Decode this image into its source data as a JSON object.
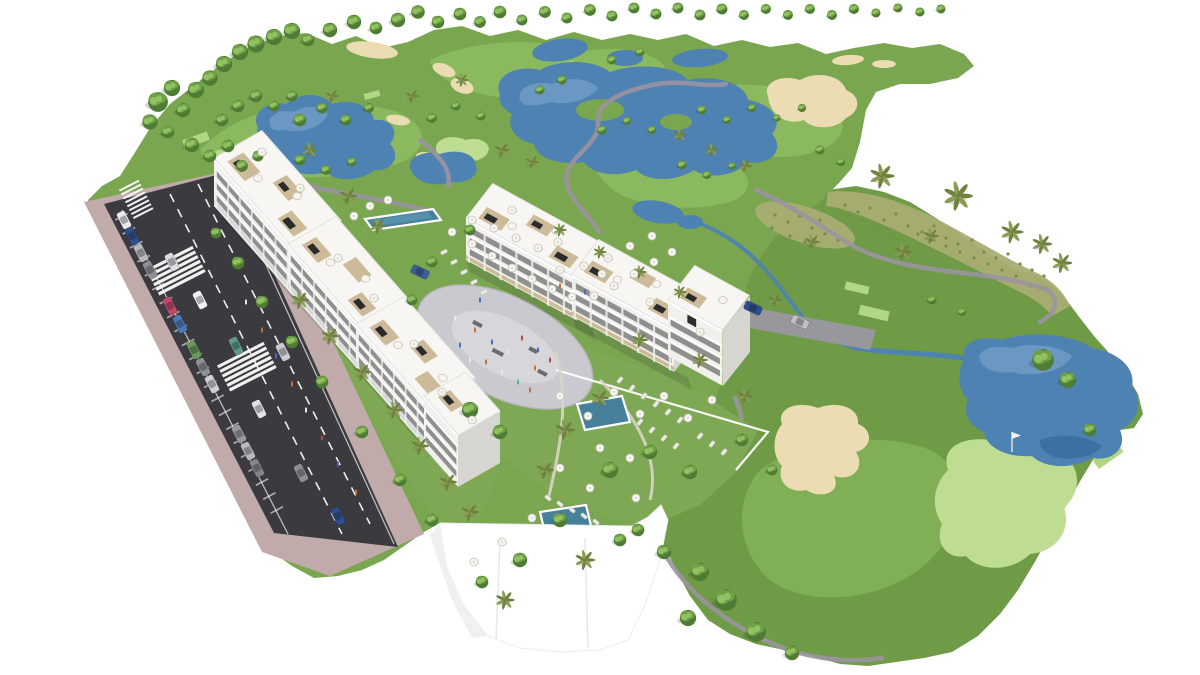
{
  "scene_label": "aerial-render-golf-resort-apartments",
  "colors": {
    "bg": "#ffffff",
    "grass": "#7aa650",
    "rough": "#6f9b47",
    "fairwayLight": "#8ebd60",
    "green": "#bedd92",
    "tee": "#b2d784",
    "sand": "#ecdcb3",
    "sandEdge": "#d5c293",
    "water": "#4d82b3",
    "waterLight": "#8db4d6",
    "waterDeep": "#2c5c94",
    "path": "#9b93a0",
    "dry": "#a9ad72",
    "drySpeck": "#7d8a4d",
    "road": "#3a3a3f",
    "sidewalk": "#c0abaa",
    "plaza": "#c9c9cf",
    "plazaInner": "#d7d7db",
    "plazaEdge": "#b7b7bd",
    "garden": "#7fa854",
    "bldg": "#f1f0ec",
    "bldgRoof": "#f7f6f3",
    "bldgShade": "#e3e2de",
    "bldgDark": "#d6d5d0",
    "win": "#3f4046",
    "wood": "#c9b692",
    "pergola": "#2b2b2d",
    "wall": "#ffffff",
    "pool": "#47809b",
    "poolLight": "#63a0b8",
    "treeDark": "#4f7c34",
    "treeMid": "#6fa046",
    "treeLight": "#92c162",
    "palm": "#6e813f",
    "palmLight": "#8a9c51",
    "trunk": "#8a7356",
    "umbTop": "#f6f5f0",
    "umbEdge": "#c9c4b8",
    "lounger": "#eceae4"
  },
  "scene": {
    "trees": [
      [
        158,
        102,
        1.1,
        "r"
      ],
      [
        172,
        88,
        0.9,
        "r"
      ],
      [
        150,
        122,
        0.85,
        "r"
      ],
      [
        183,
        110,
        0.8,
        "r"
      ],
      [
        168,
        132,
        0.7,
        "r"
      ],
      [
        196,
        90,
        0.9,
        "r"
      ],
      [
        210,
        78,
        0.85,
        "r"
      ],
      [
        224,
        64,
        0.9,
        "r"
      ],
      [
        240,
        52,
        0.9,
        "r"
      ],
      [
        256,
        44,
        0.95,
        "r"
      ],
      [
        274,
        37,
        0.9,
        "r"
      ],
      [
        292,
        31,
        0.9,
        "r"
      ],
      [
        308,
        40,
        0.7,
        "r"
      ],
      [
        222,
        120,
        0.7,
        "r"
      ],
      [
        238,
        106,
        0.7,
        "r"
      ],
      [
        256,
        96,
        0.7,
        "r"
      ],
      [
        274,
        106,
        0.6,
        "r"
      ],
      [
        292,
        96,
        0.6,
        "r"
      ],
      [
        192,
        145,
        0.8,
        "r"
      ],
      [
        210,
        156,
        0.7,
        "r"
      ],
      [
        228,
        146,
        0.7,
        "r"
      ],
      [
        242,
        166,
        0.65,
        "r"
      ],
      [
        258,
        156,
        0.6,
        "r"
      ],
      [
        330,
        30,
        0.8,
        "r"
      ],
      [
        354,
        22,
        0.8,
        "r"
      ],
      [
        376,
        28,
        0.7,
        "r"
      ],
      [
        398,
        20,
        0.8,
        "r"
      ],
      [
        418,
        12,
        0.75,
        "r"
      ],
      [
        438,
        22,
        0.7,
        "r"
      ],
      [
        460,
        14,
        0.7,
        "r"
      ],
      [
        480,
        22,
        0.65,
        "r"
      ],
      [
        500,
        12,
        0.7,
        "r"
      ],
      [
        522,
        20,
        0.6,
        "r"
      ],
      [
        545,
        12,
        0.65,
        "r"
      ],
      [
        567,
        18,
        0.6,
        "r"
      ],
      [
        590,
        10,
        0.65,
        "r"
      ],
      [
        612,
        16,
        0.6,
        "r"
      ],
      [
        634,
        8,
        0.6,
        "r"
      ],
      [
        656,
        14,
        0.6,
        "r"
      ],
      [
        678,
        8,
        0.6,
        "r"
      ],
      [
        700,
        15,
        0.6,
        "r"
      ],
      [
        722,
        9,
        0.6,
        "r"
      ],
      [
        744,
        15,
        0.55,
        "r"
      ],
      [
        766,
        9,
        0.55,
        "r"
      ],
      [
        788,
        15,
        0.55,
        "r"
      ],
      [
        810,
        9,
        0.55,
        "r"
      ],
      [
        832,
        15,
        0.55,
        "r"
      ],
      [
        854,
        9,
        0.55,
        "r"
      ],
      [
        876,
        13,
        0.5,
        "r"
      ],
      [
        898,
        8,
        0.5,
        "r"
      ],
      [
        920,
        12,
        0.5,
        "r"
      ],
      [
        941,
        9,
        0.5,
        "r"
      ],
      [
        300,
        120,
        0.7,
        "r"
      ],
      [
        322,
        108,
        0.6,
        "r"
      ],
      [
        346,
        120,
        0.6,
        "r"
      ],
      [
        369,
        108,
        0.55,
        "r"
      ],
      [
        300,
        160,
        0.6,
        "r"
      ],
      [
        326,
        170,
        0.55,
        "r"
      ],
      [
        352,
        162,
        0.5,
        "r"
      ],
      [
        432,
        118,
        0.55,
        "r"
      ],
      [
        456,
        106,
        0.5,
        "r"
      ],
      [
        481,
        116,
        0.5,
        "r"
      ],
      [
        540,
        90,
        0.5,
        "r"
      ],
      [
        562,
        80,
        0.5,
        "r"
      ],
      [
        612,
        60,
        0.5,
        "r"
      ],
      [
        640,
        52,
        0.5,
        "r"
      ],
      [
        602,
        130,
        0.5,
        "r"
      ],
      [
        627,
        121,
        0.45,
        "r"
      ],
      [
        652,
        130,
        0.45,
        "r"
      ],
      [
        702,
        110,
        0.5,
        "r"
      ],
      [
        727,
        120,
        0.45,
        "r"
      ],
      [
        752,
        108,
        0.45,
        "r"
      ],
      [
        777,
        118,
        0.4,
        "r"
      ],
      [
        802,
        108,
        0.45,
        "r"
      ],
      [
        682,
        165,
        0.5,
        "r"
      ],
      [
        707,
        175,
        0.45,
        "r"
      ],
      [
        732,
        166,
        0.4,
        "r"
      ],
      [
        820,
        150,
        0.5,
        "r"
      ],
      [
        841,
        162,
        0.45,
        "r"
      ],
      [
        1043,
        360,
        1.2,
        "r"
      ],
      [
        1068,
        380,
        0.9,
        "r"
      ],
      [
        1090,
        430,
        0.7,
        "r"
      ],
      [
        932,
        300,
        0.5,
        "r"
      ],
      [
        962,
        312,
        0.45,
        "r"
      ],
      [
        700,
        572,
        1.0,
        "r"
      ],
      [
        726,
        600,
        1.2,
        "r"
      ],
      [
        756,
        632,
        1.1,
        "r"
      ],
      [
        688,
        618,
        0.9,
        "r"
      ],
      [
        664,
        552,
        0.8,
        "r"
      ],
      [
        638,
        530,
        0.7,
        "r"
      ],
      [
        792,
        653,
        0.8,
        "r"
      ],
      [
        470,
        410,
        0.9,
        "r"
      ],
      [
        500,
        432,
        0.8,
        "r"
      ],
      [
        610,
        470,
        0.9,
        "r"
      ],
      [
        650,
        452,
        0.8,
        "r"
      ],
      [
        690,
        472,
        0.8,
        "r"
      ],
      [
        560,
        520,
        0.8,
        "r"
      ],
      [
        620,
        540,
        0.7,
        "r"
      ],
      [
        520,
        560,
        0.8,
        "r"
      ],
      [
        482,
        582,
        0.7,
        "r"
      ],
      [
        432,
        520,
        0.7,
        "r"
      ],
      [
        400,
        480,
        0.7,
        "r"
      ],
      [
        362,
        432,
        0.7,
        "r"
      ],
      [
        322,
        382,
        0.7,
        "r"
      ],
      [
        292,
        342,
        0.7,
        "r"
      ],
      [
        262,
        302,
        0.7,
        "r"
      ],
      [
        238,
        263,
        0.7,
        "r"
      ],
      [
        216,
        233,
        0.6,
        "r"
      ],
      [
        742,
        440,
        0.7,
        "r"
      ],
      [
        772,
        470,
        0.6,
        "r"
      ],
      [
        470,
        230,
        0.6,
        "r"
      ],
      [
        432,
        262,
        0.6,
        "r"
      ],
      [
        412,
        300,
        0.6,
        "r"
      ],
      [
        882,
        176,
        1.1,
        "p"
      ],
      [
        958,
        196,
        1.3,
        "p"
      ],
      [
        1012,
        232,
        1.0,
        "p"
      ],
      [
        1042,
        244,
        0.9,
        "p"
      ],
      [
        1062,
        263,
        0.9,
        "p"
      ],
      [
        903,
        252,
        0.8,
        "p"
      ],
      [
        931,
        236,
        0.7,
        "p"
      ],
      [
        348,
        196,
        0.8,
        "p"
      ],
      [
        378,
        226,
        0.75,
        "p"
      ],
      [
        300,
        300,
        0.8,
        "p"
      ],
      [
        330,
        336,
        0.8,
        "p"
      ],
      [
        362,
        372,
        0.8,
        "p"
      ],
      [
        394,
        410,
        0.8,
        "p"
      ],
      [
        420,
        446,
        0.8,
        "p"
      ],
      [
        448,
        482,
        0.8,
        "p"
      ],
      [
        470,
        512,
        0.8,
        "p"
      ],
      [
        565,
        430,
        0.9,
        "p"
      ],
      [
        600,
        398,
        0.8,
        "p"
      ],
      [
        545,
        470,
        0.8,
        "p"
      ],
      [
        585,
        560,
        0.9,
        "p"
      ],
      [
        505,
        600,
        0.85,
        "p"
      ],
      [
        640,
        340,
        0.7,
        "p"
      ],
      [
        700,
        360,
        0.7,
        "p"
      ],
      [
        745,
        396,
        0.7,
        "p"
      ],
      [
        775,
        300,
        0.6,
        "p"
      ],
      [
        812,
        242,
        0.7,
        "p"
      ],
      [
        680,
        135,
        0.6,
        "p"
      ],
      [
        712,
        150,
        0.6,
        "p"
      ],
      [
        745,
        166,
        0.6,
        "p"
      ],
      [
        310,
        150,
        0.7,
        "p"
      ],
      [
        332,
        96,
        0.6,
        "p"
      ],
      [
        502,
        150,
        0.7,
        "p"
      ],
      [
        532,
        162,
        0.6,
        "p"
      ],
      [
        412,
        96,
        0.6,
        "p"
      ],
      [
        462,
        80,
        0.6,
        "p"
      ],
      [
        560,
        230,
        0.6,
        "p"
      ],
      [
        600,
        252,
        0.6,
        "p"
      ],
      [
        640,
        272,
        0.6,
        "p"
      ],
      [
        680,
        292,
        0.6,
        "p"
      ]
    ],
    "umbrellas": [
      [
        452,
        232
      ],
      [
        472,
        244
      ],
      [
        492,
        256
      ],
      [
        512,
        268
      ],
      [
        532,
        279
      ],
      [
        552,
        289
      ],
      [
        572,
        297
      ],
      [
        594,
        296
      ],
      [
        614,
        286
      ],
      [
        634,
        274
      ],
      [
        654,
        262
      ],
      [
        672,
        252
      ],
      [
        584,
        266
      ],
      [
        560,
        270
      ],
      [
        538,
        248
      ],
      [
        516,
        238
      ],
      [
        494,
        228
      ],
      [
        472,
        220
      ],
      [
        608,
        258
      ],
      [
        630,
        246
      ],
      [
        652,
        236
      ],
      [
        370,
        206
      ],
      [
        354,
        216
      ],
      [
        388,
        200
      ],
      [
        560,
        396
      ],
      [
        588,
        416
      ],
      [
        614,
        392
      ],
      [
        640,
        414
      ],
      [
        664,
        396
      ],
      [
        688,
        418
      ],
      [
        712,
        400
      ],
      [
        600,
        448
      ],
      [
        630,
        458
      ],
      [
        560,
        468
      ],
      [
        590,
        488
      ],
      [
        636,
        498
      ],
      [
        532,
        518
      ],
      [
        502,
        542
      ],
      [
        474,
        562
      ],
      [
        262,
        152
      ],
      [
        300,
        188
      ],
      [
        338,
        258
      ],
      [
        374,
        298
      ],
      [
        414,
        344
      ],
      [
        442,
        392
      ],
      [
        472,
        420
      ],
      [
        512,
        210
      ],
      [
        558,
        242
      ],
      [
        602,
        274
      ],
      [
        650,
        302
      ],
      [
        700,
        332
      ]
    ],
    "loungers": [
      [
        620,
        380,
        40
      ],
      [
        632,
        388,
        40
      ],
      [
        644,
        396,
        40
      ],
      [
        656,
        404,
        40
      ],
      [
        668,
        412,
        40
      ],
      [
        680,
        420,
        40
      ],
      [
        652,
        430,
        40
      ],
      [
        664,
        438,
        40
      ],
      [
        676,
        446,
        40
      ],
      [
        640,
        422,
        40
      ],
      [
        444,
        252,
        63
      ],
      [
        454,
        262,
        63
      ],
      [
        464,
        272,
        63
      ],
      [
        474,
        282,
        63
      ],
      [
        484,
        292,
        63
      ],
      [
        548,
        498,
        -50
      ],
      [
        560,
        504,
        -50
      ],
      [
        572,
        510,
        -50
      ],
      [
        584,
        516,
        -50
      ],
      [
        596,
        522,
        -50
      ],
      [
        700,
        436,
        40
      ],
      [
        712,
        444,
        40
      ],
      [
        724,
        452,
        40
      ]
    ],
    "cars": [
      [
        124,
        220,
        63,
        "#e9e9ec"
      ],
      [
        132,
        236,
        63,
        "#2f4e8c"
      ],
      [
        141,
        253,
        63,
        "#b9b9bd"
      ],
      [
        150,
        270,
        63,
        "#8f9094"
      ],
      [
        170,
        306,
        63,
        "#c2486b"
      ],
      [
        180,
        324,
        63,
        "#4a78b8"
      ],
      [
        194,
        350,
        63,
        "#6a9a5a"
      ],
      [
        203,
        367,
        63,
        "#8f9094"
      ],
      [
        212,
        384,
        63,
        "#cfcfd4"
      ],
      [
        239,
        434,
        63,
        "#9a9aa0"
      ],
      [
        248,
        451,
        63,
        "#b9b9bd"
      ],
      [
        257,
        468,
        63,
        "#85868a"
      ],
      [
        200,
        300,
        63,
        "#f2f2f4"
      ],
      [
        172,
        262,
        63,
        "#dcdce0"
      ],
      [
        236,
        346,
        63,
        "#5e9a8a"
      ],
      [
        259,
        409,
        63,
        "#e2e2e4"
      ],
      [
        301,
        473,
        63,
        "#8f9094"
      ],
      [
        338,
        516,
        63,
        "#2f4e8c"
      ],
      [
        283,
        352,
        63,
        "#caccd2"
      ],
      [
        753,
        308,
        25,
        "#2f4e8c"
      ],
      [
        800,
        322,
        25,
        "#c0c0c4"
      ],
      [
        420,
        272,
        25,
        "#3a5f9e"
      ]
    ],
    "people": [
      [
        475,
        330,
        "#c96f3a"
      ],
      [
        492,
        342,
        "#4a6fb5"
      ],
      [
        508,
        352,
        "#e8e8e8"
      ],
      [
        522,
        338,
        "#b54a4a"
      ],
      [
        538,
        350,
        "#4a6fb5"
      ],
      [
        486,
        362,
        "#c96f3a"
      ],
      [
        502,
        372,
        "#e8e8e8"
      ],
      [
        518,
        382,
        "#4ab5a0"
      ],
      [
        535,
        368,
        "#c96f3a"
      ],
      [
        460,
        345,
        "#4a6fb5"
      ],
      [
        470,
        360,
        "#e8e8e8"
      ],
      [
        550,
        360,
        "#b54a4a"
      ],
      [
        262,
        330,
        "#c96f3a"
      ],
      [
        276,
        356,
        "#4a6fb5"
      ],
      [
        292,
        384,
        "#c96f3a"
      ],
      [
        306,
        410,
        "#e8e8e8"
      ],
      [
        322,
        438,
        "#b54a4a"
      ],
      [
        338,
        464,
        "#4a6fb5"
      ],
      [
        356,
        492,
        "#c96f3a"
      ],
      [
        246,
        302,
        "#e8e8e8"
      ],
      [
        560,
        286,
        "#c96f3a"
      ],
      [
        585,
        292,
        "#4a6fb5"
      ],
      [
        455,
        318,
        "#e8e8e8"
      ],
      [
        530,
        390,
        "#c96f3a"
      ],
      [
        480,
        300,
        "#4a6fb5"
      ]
    ],
    "scrub": [
      [
        845,
        205
      ],
      [
        858,
        212
      ],
      [
        870,
        208
      ],
      [
        884,
        220
      ],
      [
        896,
        214
      ],
      [
        908,
        226
      ],
      [
        922,
        232
      ],
      [
        934,
        226
      ],
      [
        946,
        238
      ],
      [
        958,
        244
      ],
      [
        972,
        240
      ],
      [
        984,
        252
      ],
      [
        996,
        258
      ],
      [
        1008,
        254
      ],
      [
        1020,
        264
      ],
      [
        1032,
        270
      ],
      [
        1044,
        276
      ],
      [
        1030,
        286
      ],
      [
        1016,
        276
      ],
      [
        1002,
        270
      ],
      [
        988,
        264
      ],
      [
        974,
        258
      ],
      [
        960,
        252
      ],
      [
        946,
        246
      ],
      [
        932,
        240
      ],
      [
        918,
        234
      ],
      [
        875,
        228
      ],
      [
        890,
        234
      ],
      [
        862,
        220
      ],
      [
        849,
        216
      ],
      [
        775,
        215
      ],
      [
        788,
        222
      ],
      [
        800,
        216
      ],
      [
        812,
        228
      ],
      [
        825,
        234
      ],
      [
        838,
        240
      ],
      [
        790,
        236
      ],
      [
        805,
        242
      ],
      [
        772,
        228
      ],
      [
        820,
        220
      ]
    ]
  }
}
